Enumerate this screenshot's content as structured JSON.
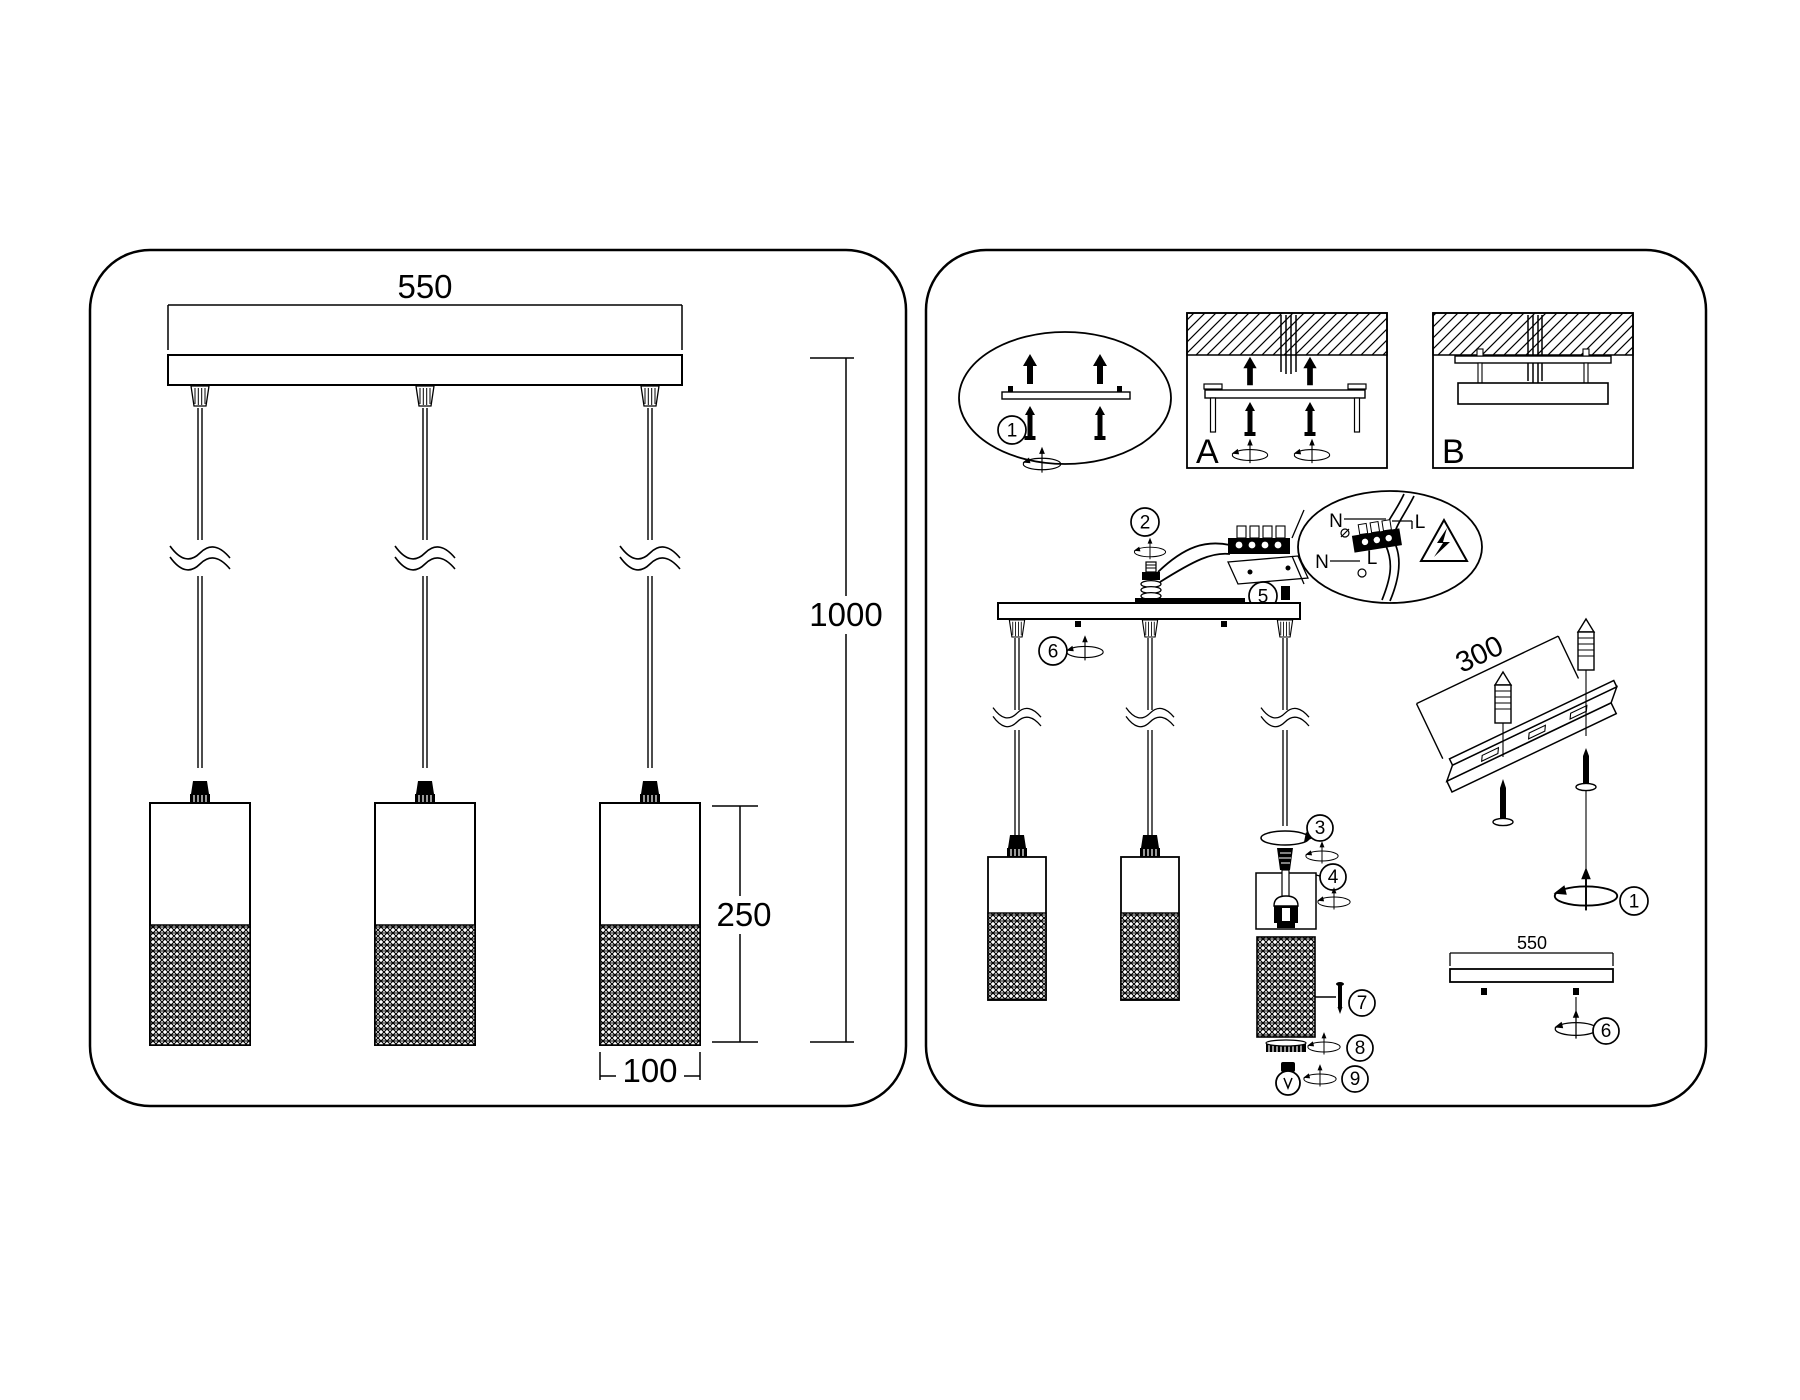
{
  "left_diagram": {
    "width_dim": "550",
    "height_dim": "1000",
    "shade_height_dim": "250",
    "shade_width_dim": "100"
  },
  "right_diagram": {
    "anchor_callout_step": "1",
    "mount_option_a": "A",
    "mount_option_b": "B",
    "steps": {
      "s2": "2",
      "s3": "3",
      "s4": "4",
      "s5": "5",
      "s6": "6",
      "s7": "7",
      "s8": "8",
      "s9": "9"
    },
    "rail_dim": "300",
    "rail_step": "1",
    "bracket_dim": "550",
    "bracket_step": "6",
    "wiring_labels": {
      "neutral_top": "N",
      "live_top": "L",
      "neutral_bottom": "N",
      "live_bottom": "L"
    }
  },
  "colors": {
    "line": "#000000",
    "background": "#ffffff"
  }
}
